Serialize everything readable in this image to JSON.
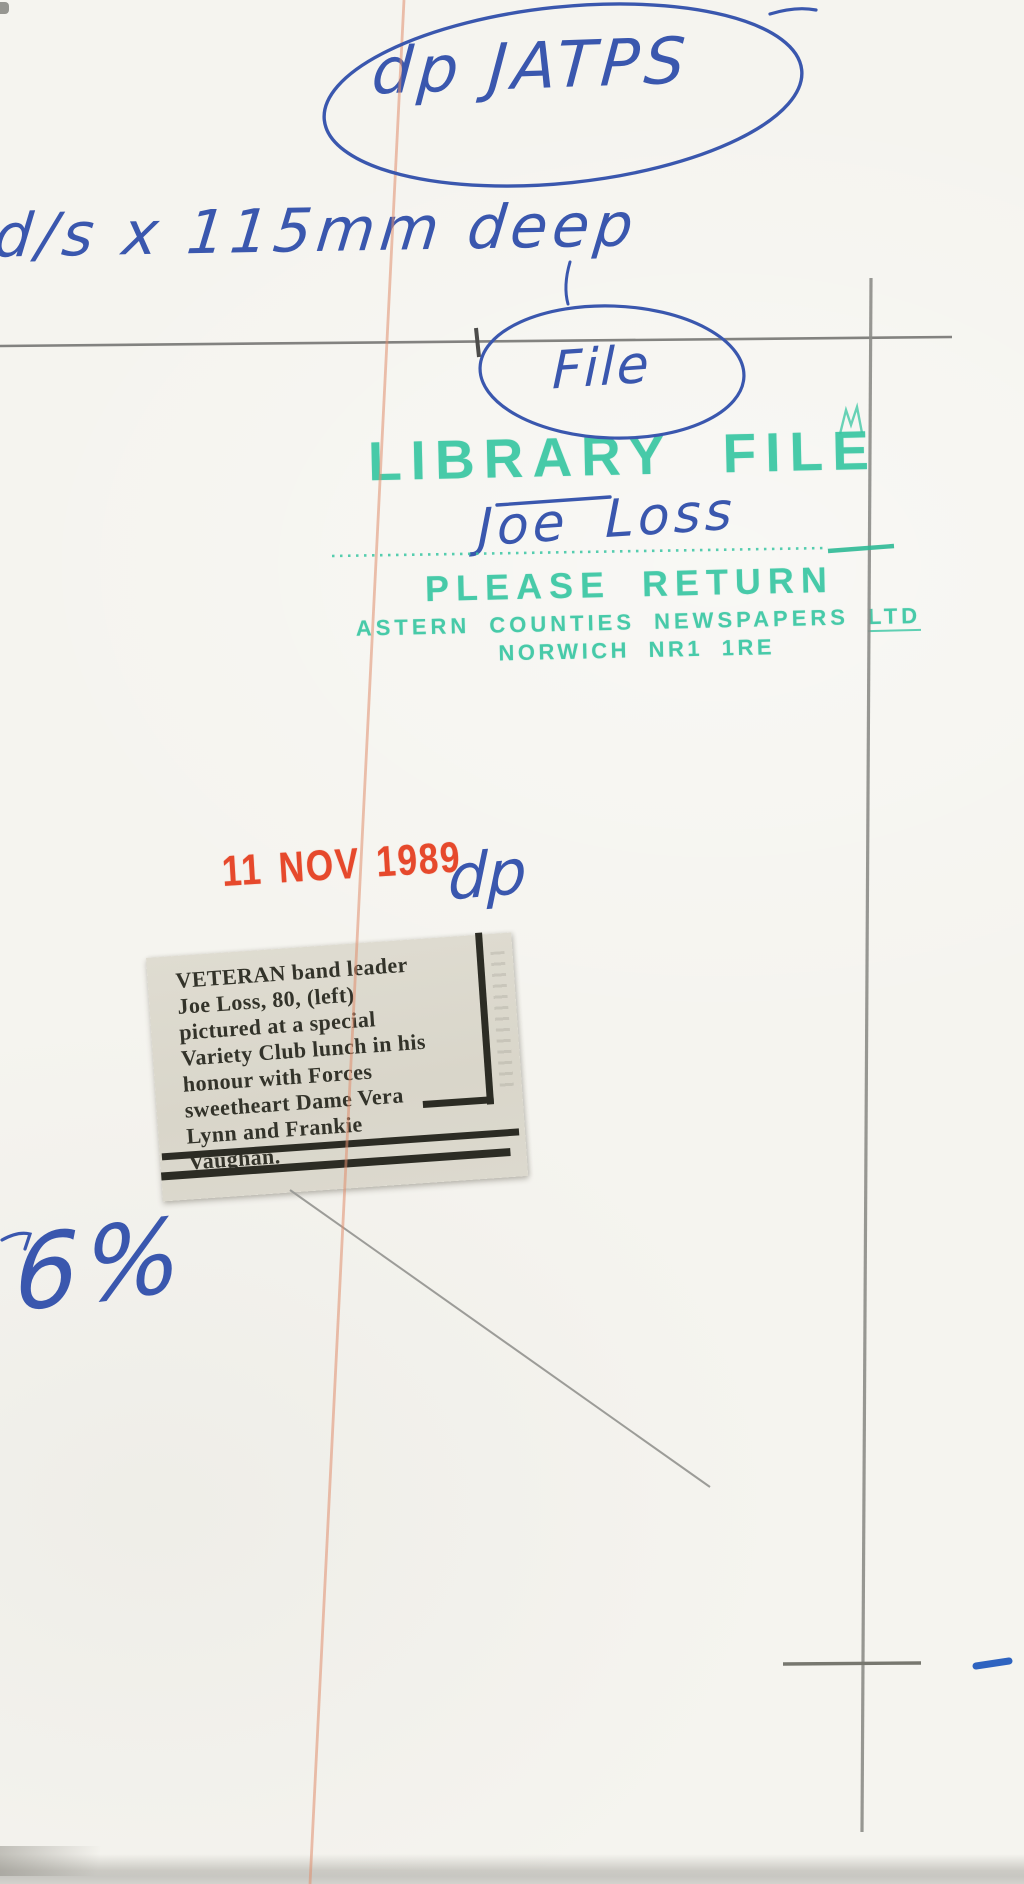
{
  "handwriting": {
    "top_code": "dp JATPS",
    "size_note": "d/s x 115mm deep",
    "file_label": "File",
    "subject_name": "Joe Loss",
    "clerk_initials": "dp",
    "percent_note": "6%"
  },
  "library_stamp": {
    "title": "LIBRARY FILE",
    "instruction": "PLEASE RETURN",
    "company": "ASTERN COUNTIES NEWSPAPERS",
    "company_suffix": "LTD",
    "address": "NORWICH NR1 1RE",
    "ink_color": "#38c6a2"
  },
  "date_stamp": {
    "text": "11 NOV 1989",
    "ink_color": "#e6492c"
  },
  "clipping": {
    "lines": [
      "VETERAN band leader",
      "Joe Loss, 80, (left)",
      "pictured at a special",
      "Variety Club lunch in his",
      "honour with Forces",
      "sweetheart Dame Vera",
      "Lynn and Frankie",
      "Vaughan."
    ]
  },
  "colors": {
    "pen_blue": "#3a57ae",
    "pencil_grey": "#8b8b87",
    "crease_red": "#e2947a",
    "paper": "#f5f4ef",
    "newsprint": "#dbd8cd"
  }
}
